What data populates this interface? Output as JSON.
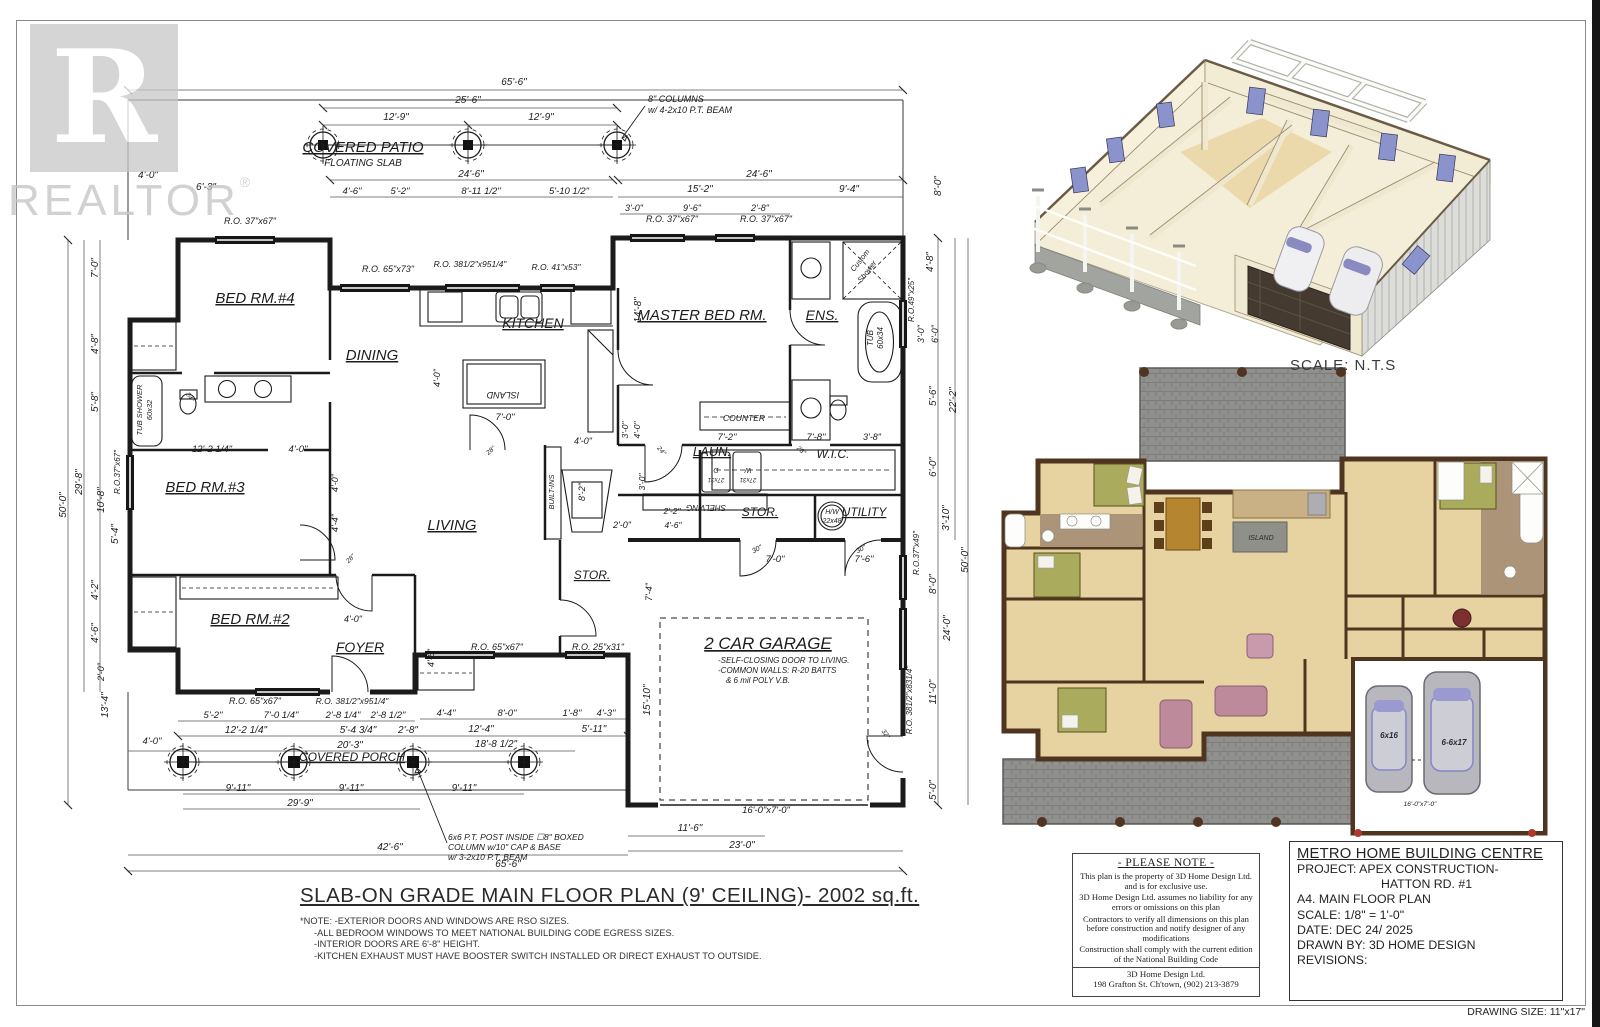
{
  "colors": {
    "ink": "#1c1c1c",
    "dim_line": "#555555",
    "watermark_gray": "#c7c7c7",
    "wall_brown": "#4f351f",
    "floor_tan": "#e7d3a2",
    "counter_tan": "#c9b185",
    "brick_gray": "#8f8f8d",
    "bath_floor": "#ac9478",
    "bed_olive": "#aaab5d",
    "table_brown": "#b5862f",
    "island_gray": "#90908a",
    "sofa_mauve": "#bd8a9c",
    "car_gray": "#b7b7bd",
    "car_glass": "#9a9ad0",
    "cream_wall": "#f4eed8",
    "window_blue": "#8a93cc",
    "deck_gray": "#a2a4a0",
    "garage_door_dark": "#453a30",
    "red_dot": "#b03a2a"
  },
  "watermark": {
    "brand": "REALTOR",
    "reg": "®",
    "letter": "R"
  },
  "scale_note": "SCALE: N.T.S",
  "main_title": "SLAB-ON GRADE MAIN FLOOR PLAN (9' CEILING)- 2002 sq.ft.",
  "notes": [
    "*NOTE: -EXTERIOR DOORS AND WINDOWS ARE RSO SIZES.",
    "-ALL BEDROOM WINDOWS TO MEET NATIONAL BUILDING CODE EGRESS SIZES.",
    "-INTERIOR DOORS ARE 6'-8\" HEIGHT.",
    "-KITCHEN EXHAUST MUST HAVE BOOSTER SWITCH INSTALLED OR DIRECT EXHAUST TO OUTSIDE."
  ],
  "please_note": {
    "title": "- PLEASE NOTE -",
    "paragraphs": [
      "This plan is the property of  3D Home Design Ltd. and is for exclusive use.",
      "3D Home Design Ltd. assumes no liability for any errors or omissions on this plan",
      "Contractors to verify all dimensions on this plan before construction and notify designer of any modifications",
      "Construction shall comply with  the current edition of the National Building Code"
    ],
    "firm": "3D Home Design Ltd.",
    "address": "198 Grafton St. Ch'town, (902) 213-3879"
  },
  "title_block": {
    "company": "METRO HOME BUILDING CENTRE",
    "project_line1": "PROJECT: APEX CONSTRUCTION-",
    "project_line2": "HATTON RD. #1",
    "sheet": "A4. MAIN FLOOR PLAN",
    "scale": "SCALE: 1/8\" = 1'-0\"",
    "date": "DATE: DEC 24/ 2025",
    "drawn_by": "DRAWN BY: 3D HOME DESIGN",
    "revisions": "REVISIONS:"
  },
  "drawing_size": "DRAWING SIZE: 11\"x17\"",
  "plan": {
    "labels": [
      {
        "t": "COVERED PATIO",
        "x": 363,
        "y": 152,
        "s": 15,
        "u": 1
      },
      {
        "t": "FLOATING SLAB",
        "x": 363,
        "y": 166,
        "s": 10
      },
      {
        "t": "BED RM.#4",
        "x": 255,
        "y": 303,
        "s": 15,
        "u": 1
      },
      {
        "t": "DINING",
        "x": 372,
        "y": 360,
        "s": 15,
        "u": 1
      },
      {
        "t": "KITCHEN",
        "x": 533,
        "y": 328,
        "s": 14,
        "u": 1
      },
      {
        "t": "MASTER BED RM.",
        "x": 702,
        "y": 320,
        "s": 15,
        "u": 1
      },
      {
        "t": "ENS.",
        "x": 822,
        "y": 320,
        "s": 14,
        "u": 1
      },
      {
        "t": "BED RM.#3",
        "x": 205,
        "y": 492,
        "s": 15,
        "u": 1
      },
      {
        "t": "LIVING",
        "x": 452,
        "y": 530,
        "s": 15,
        "u": 1
      },
      {
        "t": "BED RM.#2",
        "x": 250,
        "y": 624,
        "s": 15,
        "u": 1
      },
      {
        "t": "FOYER",
        "x": 360,
        "y": 652,
        "s": 14,
        "u": 1
      },
      {
        "t": "LAUN.",
        "x": 712,
        "y": 456,
        "s": 13,
        "u": 1
      },
      {
        "t": "W.I.C.",
        "x": 833,
        "y": 458,
        "s": 12
      },
      {
        "t": "STOR.",
        "x": 760,
        "y": 516,
        "s": 12,
        "u": 1
      },
      {
        "t": "UTILITY",
        "x": 864,
        "y": 516,
        "s": 12,
        "u": 1
      },
      {
        "t": "STOR.",
        "x": 592,
        "y": 579,
        "s": 12,
        "u": 1
      },
      {
        "t": "2 CAR GARAGE",
        "x": 768,
        "y": 649,
        "s": 17,
        "u": 1
      },
      {
        "t": "-SELF-CLOSING DOOR TO LIVING.",
        "x": 718,
        "y": 663,
        "s": 8,
        "a": "s"
      },
      {
        "t": "-COMMON WALLS: R-20 BATTS",
        "x": 718,
        "y": 673,
        "s": 8,
        "a": "s"
      },
      {
        "t": "& 6 mil POLY V.B.",
        "x": 726,
        "y": 683,
        "s": 8,
        "a": "s"
      },
      {
        "t": "COVERED PORCH",
        "x": 352,
        "y": 761,
        "s": 12,
        "u": 1
      },
      {
        "t": "COUNTER",
        "x": 744,
        "y": 421,
        "s": 8.5
      },
      {
        "t": "BUILT-INS",
        "x": 554,
        "y": 492,
        "s": 7.5,
        "r": -90
      },
      {
        "t": "ISLAND",
        "x": 503,
        "y": 392,
        "s": 9,
        "r": 180
      },
      {
        "t": "TUB SHOWER",
        "x": 142,
        "y": 410,
        "s": 7.5,
        "r": -90
      },
      {
        "t": "60x32",
        "x": 152,
        "y": 410,
        "s": 7.5,
        "r": -90
      },
      {
        "t": "Custom",
        "x": 862,
        "y": 262,
        "s": 7.5,
        "r": -52
      },
      {
        "t": "Shower",
        "x": 869,
        "y": 273,
        "s": 7.5,
        "r": -52
      },
      {
        "t": "TUB",
        "x": 873,
        "y": 338,
        "s": 8,
        "r": -90
      },
      {
        "t": "60x34",
        "x": 883,
        "y": 338,
        "s": 8,
        "r": -90
      },
      {
        "t": "H/W",
        "x": 832,
        "y": 514,
        "s": 7
      },
      {
        "t": "22x48",
        "x": 832,
        "y": 523,
        "s": 7
      },
      {
        "t": "SHELVING",
        "x": 706,
        "y": 505,
        "s": 8,
        "r": 180
      },
      {
        "t": "W",
        "x": 748,
        "y": 468,
        "s": 7,
        "r": 180
      },
      {
        "t": "27x31",
        "x": 748,
        "y": 478,
        "s": 6,
        "r": 180
      },
      {
        "t": "D",
        "x": 716,
        "y": 468,
        "s": 7,
        "r": 180
      },
      {
        "t": "27x31",
        "x": 716,
        "y": 478,
        "s": 6,
        "r": 180
      },
      {
        "t": "16'-0\"x7'-0\"",
        "x": 766,
        "y": 813,
        "s": 9.5
      },
      {
        "t": "8\" COLUMNS",
        "x": 648,
        "y": 102,
        "s": 9,
        "a": "s"
      },
      {
        "t": "w/ 4-2x10 P.T. BEAM",
        "x": 648,
        "y": 113,
        "s": 9,
        "a": "s"
      },
      {
        "t": "6x6 P.T. POST INSIDE ☐8\" BOXED",
        "x": 448,
        "y": 840,
        "s": 8.5,
        "a": "s"
      },
      {
        "t": "COLUMN w/10\" CAP & BASE",
        "x": 448,
        "y": 850,
        "s": 8.5,
        "a": "s"
      },
      {
        "t": "w/ 3-2x10 P.T. BEAM",
        "x": 448,
        "y": 860,
        "s": 8.5,
        "a": "s"
      },
      {
        "t": "65'-6\"",
        "x": 514,
        "y": 85
      },
      {
        "t": "25'-6\"",
        "x": 468,
        "y": 103
      },
      {
        "t": "12'-9\"",
        "x": 396,
        "y": 120
      },
      {
        "t": "12'-9\"",
        "x": 541,
        "y": 120
      },
      {
        "t": "4'-0\"",
        "x": 148,
        "y": 178
      },
      {
        "t": "6'-3\"",
        "x": 206,
        "y": 190
      },
      {
        "t": "24'-6\"",
        "x": 471,
        "y": 177
      },
      {
        "t": "24'-6\"",
        "x": 759,
        "y": 177
      },
      {
        "t": "4'-6\"",
        "x": 352,
        "y": 194,
        "s": 9.5
      },
      {
        "t": "5'-2\"",
        "x": 400,
        "y": 194,
        "s": 9.5
      },
      {
        "t": "8'-11 1/2\"",
        "x": 481,
        "y": 194,
        "s": 9.5
      },
      {
        "t": "5'-10 1/2\"",
        "x": 569,
        "y": 194,
        "s": 9.5
      },
      {
        "t": "15'-2\"",
        "x": 700,
        "y": 192
      },
      {
        "t": "9'-4\"",
        "x": 849,
        "y": 192
      },
      {
        "t": "3'-0\"",
        "x": 634,
        "y": 211,
        "s": 9
      },
      {
        "t": "9'-6\"",
        "x": 692,
        "y": 211,
        "s": 9
      },
      {
        "t": "2'-8\"",
        "x": 760,
        "y": 211,
        "s": 9
      },
      {
        "t": "R.O. 37\"x67\"",
        "x": 250,
        "y": 224,
        "s": 9
      },
      {
        "t": "R.O. 37\"x67\"",
        "x": 672,
        "y": 222,
        "s": 9
      },
      {
        "t": "R.O. 37\"x67\"",
        "x": 766,
        "y": 222,
        "s": 9
      },
      {
        "t": "R.O. 65\"x73\"",
        "x": 388,
        "y": 272,
        "s": 9
      },
      {
        "t": "R.O. 381/2\"x951/4\"",
        "x": 470,
        "y": 267,
        "s": 8.5
      },
      {
        "t": "R.O. 41\"x53\"",
        "x": 556,
        "y": 270,
        "s": 8.5
      },
      {
        "t": "50'-0\"",
        "x": 66,
        "y": 505,
        "r": -90
      },
      {
        "t": "29'-8\"",
        "x": 82,
        "y": 482,
        "r": -90
      },
      {
        "t": "7'-0\"",
        "x": 98,
        "y": 268,
        "r": -90
      },
      {
        "t": "4'-8\"",
        "x": 98,
        "y": 344,
        "r": -90
      },
      {
        "t": "5'-8\"",
        "x": 98,
        "y": 402,
        "r": -90
      },
      {
        "t": "R.O.37\"x67\"",
        "x": 120,
        "y": 472,
        "r": -90,
        "s": 8
      },
      {
        "t": "10'-8\"",
        "x": 104,
        "y": 500,
        "r": -90
      },
      {
        "t": "5'-4\"",
        "x": 118,
        "y": 534,
        "r": -90
      },
      {
        "t": "4'-2\"",
        "x": 98,
        "y": 590,
        "r": -90
      },
      {
        "t": "4'-6\"",
        "x": 98,
        "y": 633,
        "r": -90
      },
      {
        "t": "2'-0\"",
        "x": 104,
        "y": 672,
        "r": -90,
        "s": 9
      },
      {
        "t": "13'-4\"",
        "x": 108,
        "y": 705,
        "r": -90
      },
      {
        "t": "4'-0\"",
        "x": 152,
        "y": 744,
        "s": 9.5
      },
      {
        "t": "8'-0\"",
        "x": 941,
        "y": 186,
        "r": -90
      },
      {
        "t": "4'-8\"",
        "x": 933,
        "y": 262,
        "r": -90
      },
      {
        "t": "R.O.49\"x25\"",
        "x": 914,
        "y": 300,
        "r": -90,
        "s": 8
      },
      {
        "t": "3'-0\"",
        "x": 924,
        "y": 334,
        "r": -90,
        "s": 9
      },
      {
        "t": "6'-0\"",
        "x": 938,
        "y": 334,
        "r": -90,
        "s": 9
      },
      {
        "t": "5'-6\"",
        "x": 936,
        "y": 396,
        "r": -90
      },
      {
        "t": "22'-2\"",
        "x": 956,
        "y": 400,
        "r": -90
      },
      {
        "t": "6'-0\"",
        "x": 936,
        "y": 467,
        "r": -90
      },
      {
        "t": "3'-10\"",
        "x": 949,
        "y": 518,
        "r": -90
      },
      {
        "t": "R.O.37\"x49\"",
        "x": 919,
        "y": 553,
        "r": -90,
        "s": 8
      },
      {
        "t": "8'-0\"",
        "x": 936,
        "y": 584,
        "r": -90
      },
      {
        "t": "50'-0\"",
        "x": 968,
        "y": 560,
        "r": -90
      },
      {
        "t": "24'-0\"",
        "x": 950,
        "y": 628,
        "r": -90
      },
      {
        "t": "11'-0\"",
        "x": 936,
        "y": 692,
        "r": -90
      },
      {
        "t": "R.O. 381/2\"x831/4\"",
        "x": 912,
        "y": 700,
        "r": -90,
        "s": 8
      },
      {
        "t": "5'-0\"",
        "x": 936,
        "y": 790,
        "r": -90
      },
      {
        "t": "15'-10\"",
        "x": 650,
        "y": 700,
        "r": -90
      },
      {
        "t": "7'-4\"",
        "x": 652,
        "y": 592,
        "r": -90,
        "s": 9
      },
      {
        "t": "14'-8\"",
        "x": 641,
        "y": 310,
        "r": -90
      },
      {
        "t": "8'-2\"",
        "x": 585,
        "y": 492,
        "r": -90,
        "s": 9
      },
      {
        "t": "4'-0\"",
        "x": 583,
        "y": 444,
        "s": 9
      },
      {
        "t": "2'-0\"",
        "x": 622,
        "y": 528,
        "s": 9
      },
      {
        "t": "3'-0\"",
        "x": 645,
        "y": 482,
        "r": -90,
        "s": 8.5
      },
      {
        "t": "4'-0\"",
        "x": 440,
        "y": 378,
        "r": -90,
        "s": 9
      },
      {
        "t": "7'-0\"",
        "x": 505,
        "y": 420,
        "s": 9.5
      },
      {
        "t": "7'-2\"",
        "x": 727,
        "y": 440,
        "s": 9.5
      },
      {
        "t": "7'-8\"",
        "x": 816,
        "y": 440,
        "s": 9.5
      },
      {
        "t": "3'-8\"",
        "x": 872,
        "y": 440,
        "s": 9
      },
      {
        "t": "3'-0\"",
        "x": 628,
        "y": 430,
        "r": -90,
        "s": 8.5
      },
      {
        "t": "4'-0\"",
        "x": 640,
        "y": 430,
        "r": -90,
        "s": 8.5
      },
      {
        "t": "2'-2\"",
        "x": 672,
        "y": 514,
        "s": 8.5
      },
      {
        "t": "4'-6\"",
        "x": 673,
        "y": 528,
        "s": 8.5
      },
      {
        "t": "7'-0\"",
        "x": 775,
        "y": 562,
        "s": 9.5
      },
      {
        "t": "7'-6\"",
        "x": 864,
        "y": 562,
        "s": 9.5
      },
      {
        "t": "30\"",
        "x": 758,
        "y": 551,
        "s": 7,
        "r": -28
      },
      {
        "t": "30\"",
        "x": 862,
        "y": 551,
        "s": 7,
        "r": -28
      },
      {
        "t": "4'-0\"",
        "x": 353,
        "y": 622,
        "s": 9
      },
      {
        "t": "4'-6\"",
        "x": 434,
        "y": 658,
        "r": -90,
        "s": 9
      },
      {
        "t": "4'-0\"",
        "x": 338,
        "y": 483,
        "r": -90,
        "s": 9
      },
      {
        "t": "4'-4\"",
        "x": 338,
        "y": 523,
        "r": -90,
        "s": 9
      },
      {
        "t": "12'-2 1/4\"",
        "x": 212,
        "y": 452,
        "s": 9.5
      },
      {
        "t": "4'-0\"",
        "x": 298,
        "y": 452,
        "s": 9.5
      },
      {
        "t": "R.O. 65\"x67\"",
        "x": 255,
        "y": 704,
        "s": 9
      },
      {
        "t": "R.O. 381/2\"x951/4\"",
        "x": 352,
        "y": 704,
        "s": 8.5
      },
      {
        "t": "R.O. 65\"x67\"",
        "x": 497,
        "y": 650,
        "s": 9
      },
      {
        "t": "R.O. 25\"x31\"",
        "x": 598,
        "y": 650,
        "s": 9
      },
      {
        "t": "5'-2\"",
        "x": 213,
        "y": 718,
        "s": 9.5
      },
      {
        "t": "7'-0 1/4\"",
        "x": 281,
        "y": 718,
        "s": 9.5
      },
      {
        "t": "2'-8 1/4\"",
        "x": 343,
        "y": 718,
        "s": 9.5
      },
      {
        "t": "2'-8 1/2\"",
        "x": 388,
        "y": 718,
        "s": 9.5
      },
      {
        "t": "4'-4\"",
        "x": 446,
        "y": 716,
        "s": 9.5
      },
      {
        "t": "8'-0\"",
        "x": 507,
        "y": 716,
        "s": 9.5
      },
      {
        "t": "1'-8\"",
        "x": 572,
        "y": 716,
        "s": 9.5
      },
      {
        "t": "4'-3\"",
        "x": 606,
        "y": 716,
        "s": 9.5
      },
      {
        "t": "12'-2 1/4\"",
        "x": 246,
        "y": 733
      },
      {
        "t": "5'-4 3/4\"",
        "x": 358,
        "y": 733
      },
      {
        "t": "2'-8\"",
        "x": 408,
        "y": 733
      },
      {
        "t": "12'-4\"",
        "x": 481,
        "y": 732
      },
      {
        "t": "5'-11\"",
        "x": 594,
        "y": 732
      },
      {
        "t": "20'-3\"",
        "x": 350,
        "y": 748
      },
      {
        "t": "18'-8 1/2\"",
        "x": 496,
        "y": 747
      },
      {
        "t": "9'-11\"",
        "x": 238,
        "y": 791
      },
      {
        "t": "9'-11\"",
        "x": 351,
        "y": 791
      },
      {
        "t": "9'-11\"",
        "x": 464,
        "y": 791
      },
      {
        "t": "29'-9\"",
        "x": 300,
        "y": 806
      },
      {
        "t": "42'-6\"",
        "x": 390,
        "y": 850
      },
      {
        "t": "65'-6\"",
        "x": 508,
        "y": 867
      },
      {
        "t": "11'-6\"",
        "x": 690,
        "y": 831
      },
      {
        "t": "23'-0\"",
        "x": 742,
        "y": 848
      },
      {
        "t": "28\"",
        "x": 492,
        "y": 452,
        "s": 6.5,
        "r": -40
      },
      {
        "t": "24\"",
        "x": 188,
        "y": 398,
        "s": 6.5,
        "r": 60
      },
      {
        "t": "28\"",
        "x": 352,
        "y": 560,
        "s": 6.5,
        "r": -45
      },
      {
        "t": "28\"",
        "x": 800,
        "y": 452,
        "s": 6.5,
        "r": 40
      },
      {
        "t": "32\"",
        "x": 884,
        "y": 735,
        "s": 6.5,
        "r": 55
      },
      {
        "t": "24\"",
        "x": 660,
        "y": 452,
        "s": 6.5,
        "r": 50
      },
      {
        "t": "ISLAND",
        "x": 1261,
        "y": 540,
        "s": 7,
        "fl": "#2f2a1a"
      },
      {
        "t": "6x16",
        "x": 1389,
        "y": 738,
        "s": 8,
        "fl": "#2b2b36",
        "w": 700
      },
      {
        "t": "6-6x17",
        "x": 1454,
        "y": 745,
        "s": 8,
        "fl": "#2b2b36",
        "w": 700
      },
      {
        "t": "16'-0\"x7'-0\"",
        "x": 1420,
        "y": 806,
        "s": 6.5,
        "fl": "#1a1a1a"
      }
    ]
  }
}
